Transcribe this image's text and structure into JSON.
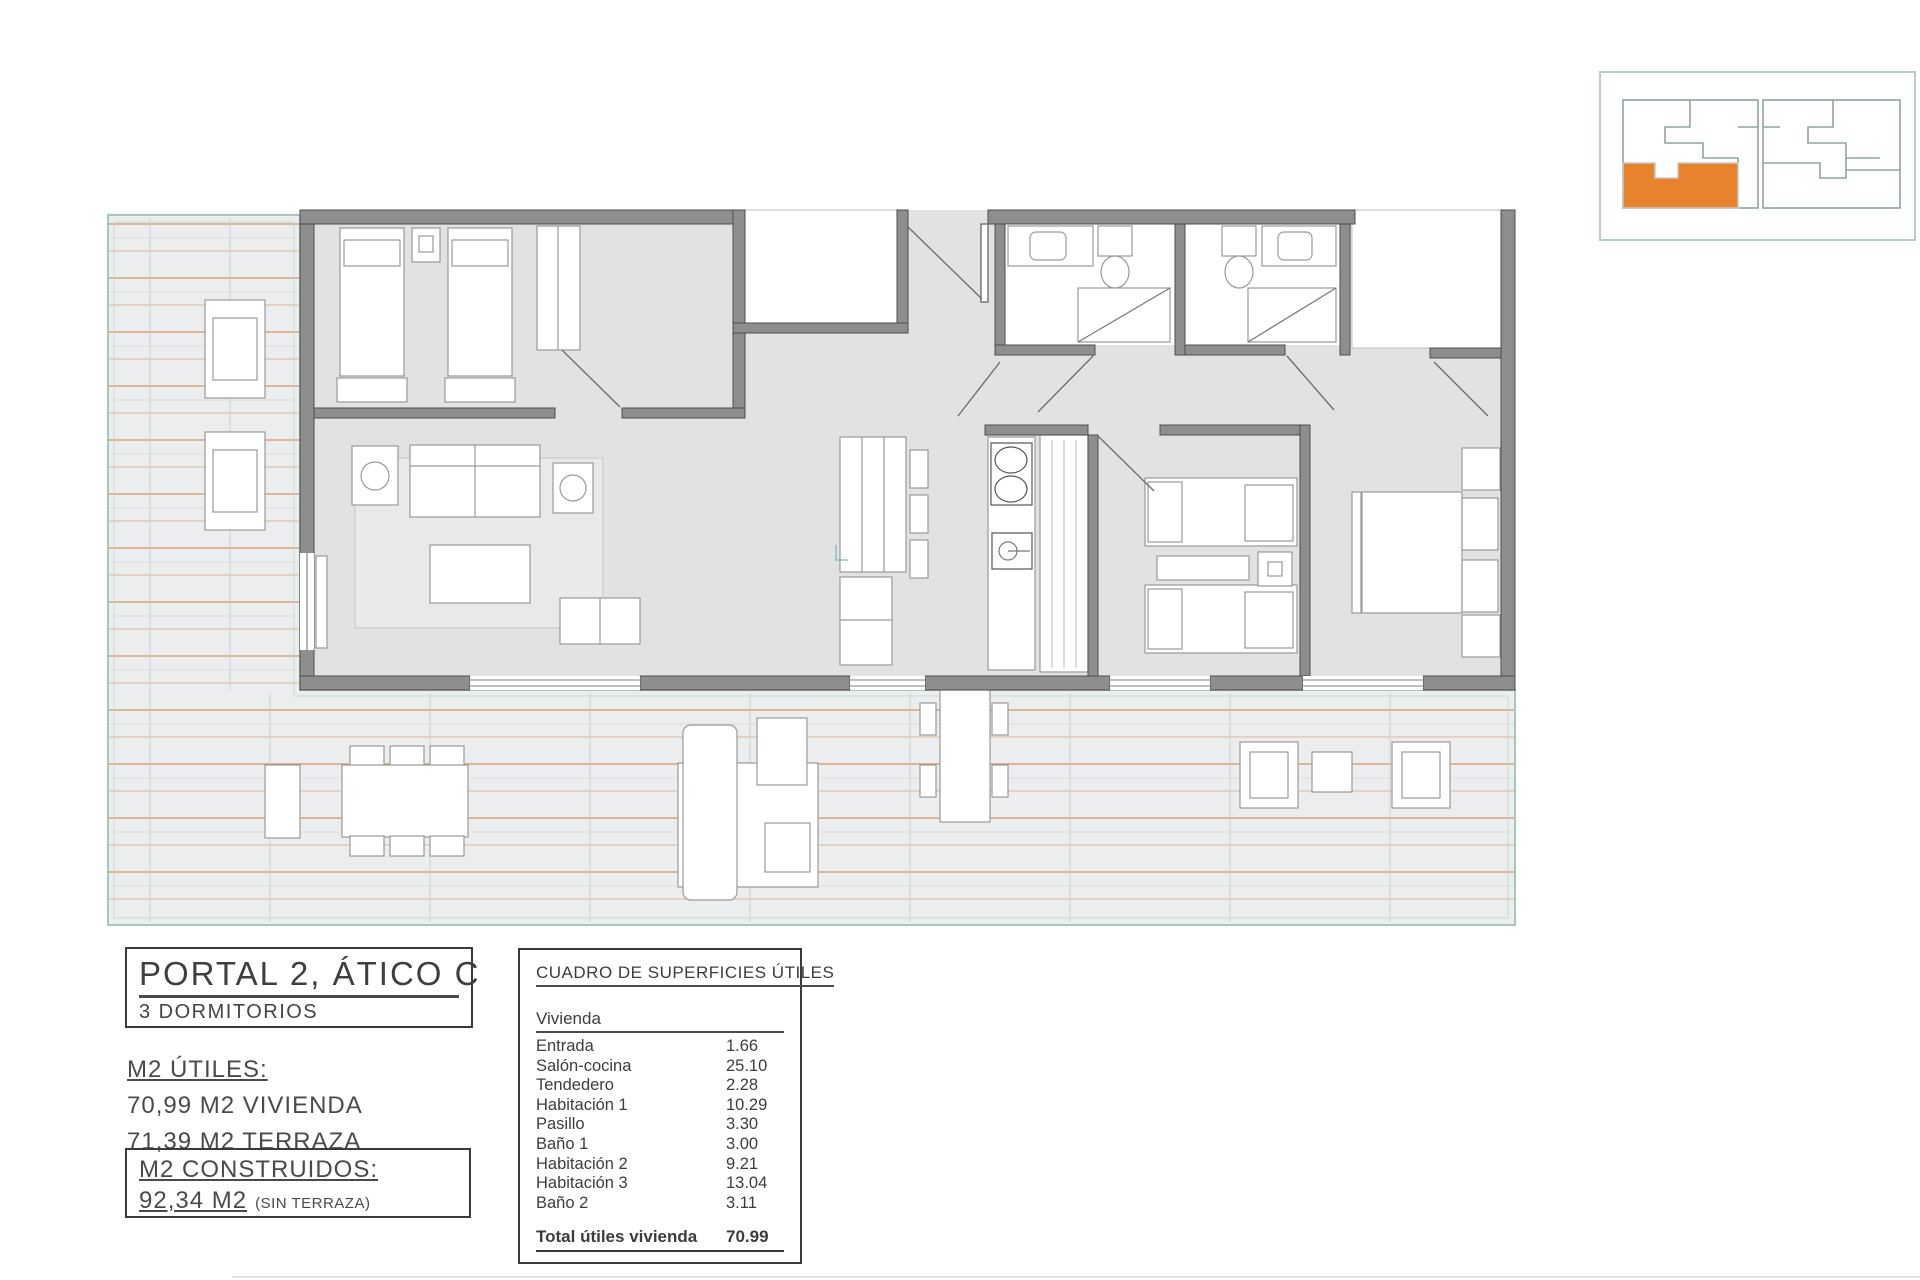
{
  "title_block": {
    "title": "PORTAL 2, ÁTICO C",
    "subtitle": "3 DORMITORIOS"
  },
  "m2_utiles": {
    "heading": "M2 ÚTILES:",
    "lines": [
      "70,99 M2 VIVIENDA",
      "71,39 M2 TERRAZA"
    ]
  },
  "m2_construidos": {
    "heading": "M2 CONSTRUIDOS:",
    "value": "92,34 M2",
    "note": "(SIN TERRAZA)"
  },
  "areas_table": {
    "title": "CUADRO DE SUPERFICIES ÚTILES",
    "group_header": "Vivienda",
    "rows": [
      {
        "label": "Entrada",
        "value": "1.66"
      },
      {
        "label": "Salón-cocina",
        "value": "25.10"
      },
      {
        "label": "Tendedero",
        "value": "2.28"
      },
      {
        "label": "Habitación 1",
        "value": "10.29"
      },
      {
        "label": "Pasillo",
        "value": "3.30"
      },
      {
        "label": "Baño 1",
        "value": "3.00"
      },
      {
        "label": "Habitación 2",
        "value": "9.21"
      },
      {
        "label": "Habitación 3",
        "value": "13.04"
      },
      {
        "label": "Baño 2",
        "value": "3.11"
      }
    ],
    "total": {
      "label": "Total útiles vivienda",
      "value": "70.99"
    }
  },
  "key_plan": {
    "highlight_color": "#E8832D",
    "outline_color": "#8FA79A",
    "border_color": "#B9CFC4"
  },
  "floor_plan": {
    "rooms": [
      "Entrada",
      "Salón-cocina",
      "Tendedero",
      "Habitación 1",
      "Pasillo",
      "Baño 1",
      "Habitación 2",
      "Habitación 3",
      "Baño 2",
      "Terraza"
    ],
    "colors": {
      "wall": "#8E8E8E",
      "wall_edge": "#4D4D4D",
      "room_floor": "#E2E2E4",
      "deck": "#EBEDEE",
      "deck_line": "#CF8A50",
      "terrace_border": "#A5C9B7",
      "furniture_stroke": "#9A9A9A"
    }
  }
}
